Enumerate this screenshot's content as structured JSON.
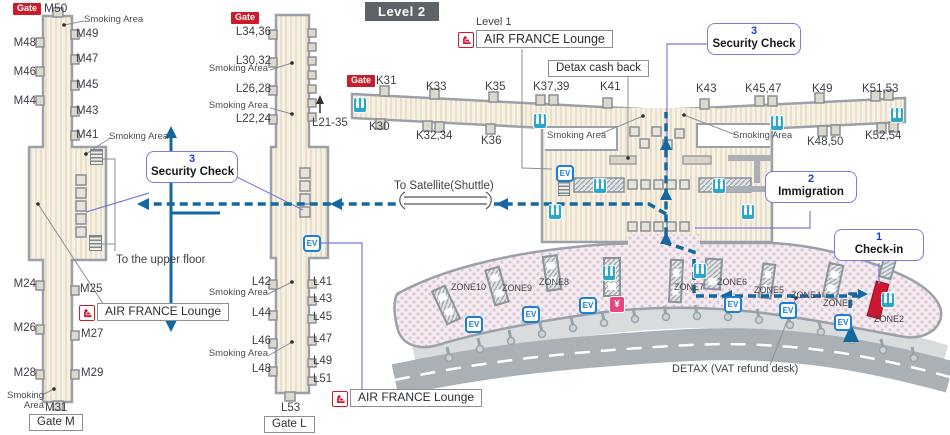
{
  "colors": {
    "route_blue": "#15689f",
    "info_border": "#7b7be0",
    "badge_red": "#cc1b2b",
    "toilet_teal": "#2ba7c9",
    "yen_pink": "#e8457d",
    "counter_red": "#c9182f",
    "level_badge_bg": "#5d6369",
    "pier_fill": "#f7f1e5",
    "hall_fill": "#f5ecf1"
  },
  "legend": {
    "level_badge": "Level 2",
    "level1": "Level 1",
    "gate_badge": "Gate",
    "smoking": "Smoking Area",
    "lounge": "AIR FRANCE Lounge",
    "detax_box": "Detax cash back",
    "detax_desk": "DETAX (VAT refund desk)",
    "shuttle": "To Satellite(Shuttle)",
    "upper_floor": "To the upper floor"
  },
  "steps": {
    "checkin": {
      "num": "1",
      "label": "Check-in"
    },
    "immigration": {
      "num": "2",
      "label": "Immigration"
    },
    "security": {
      "num": "3",
      "label": "Security Check"
    }
  },
  "m_pier": {
    "top": "M50",
    "upper_left": [
      "M48",
      "M46",
      "M44"
    ],
    "upper_right": [
      "M49",
      "M47",
      "M45",
      "M43",
      "M41"
    ],
    "lower_left": [
      "M24",
      "M26",
      "M28"
    ],
    "lower_right": [
      "M25",
      "M27",
      "M29"
    ],
    "bottom": "M31",
    "gate_box": "Gate M"
  },
  "l_pier": {
    "upper_left": [
      "L34,36",
      "L30,32",
      "L26,28",
      "L22,24"
    ],
    "range": "L21-35",
    "lower_left": [
      "L42",
      "L44",
      "L46",
      "L48"
    ],
    "lower_right": [
      "L41",
      "L43",
      "L45",
      "L47",
      "L49",
      "L51"
    ],
    "bottom": "L53",
    "gate_box": "Gate L"
  },
  "k_concourse": {
    "first": "K31",
    "top": [
      "K33",
      "K35",
      "K37,39",
      "K41",
      "K43",
      "K45,47",
      "K49",
      "K51,53"
    ],
    "bottom": [
      "K30",
      "K32,34",
      "K36",
      "K48,50",
      "K52,54"
    ]
  },
  "hall": {
    "zones": [
      "ZONE10",
      "ZONE9",
      "ZONE8",
      "ZONE7",
      "ZONE6",
      "ZONE5",
      "ZONE4",
      "ZONE3",
      "ZONE2"
    ]
  },
  "icons": {
    "ev": "EV",
    "yen": "¥"
  }
}
